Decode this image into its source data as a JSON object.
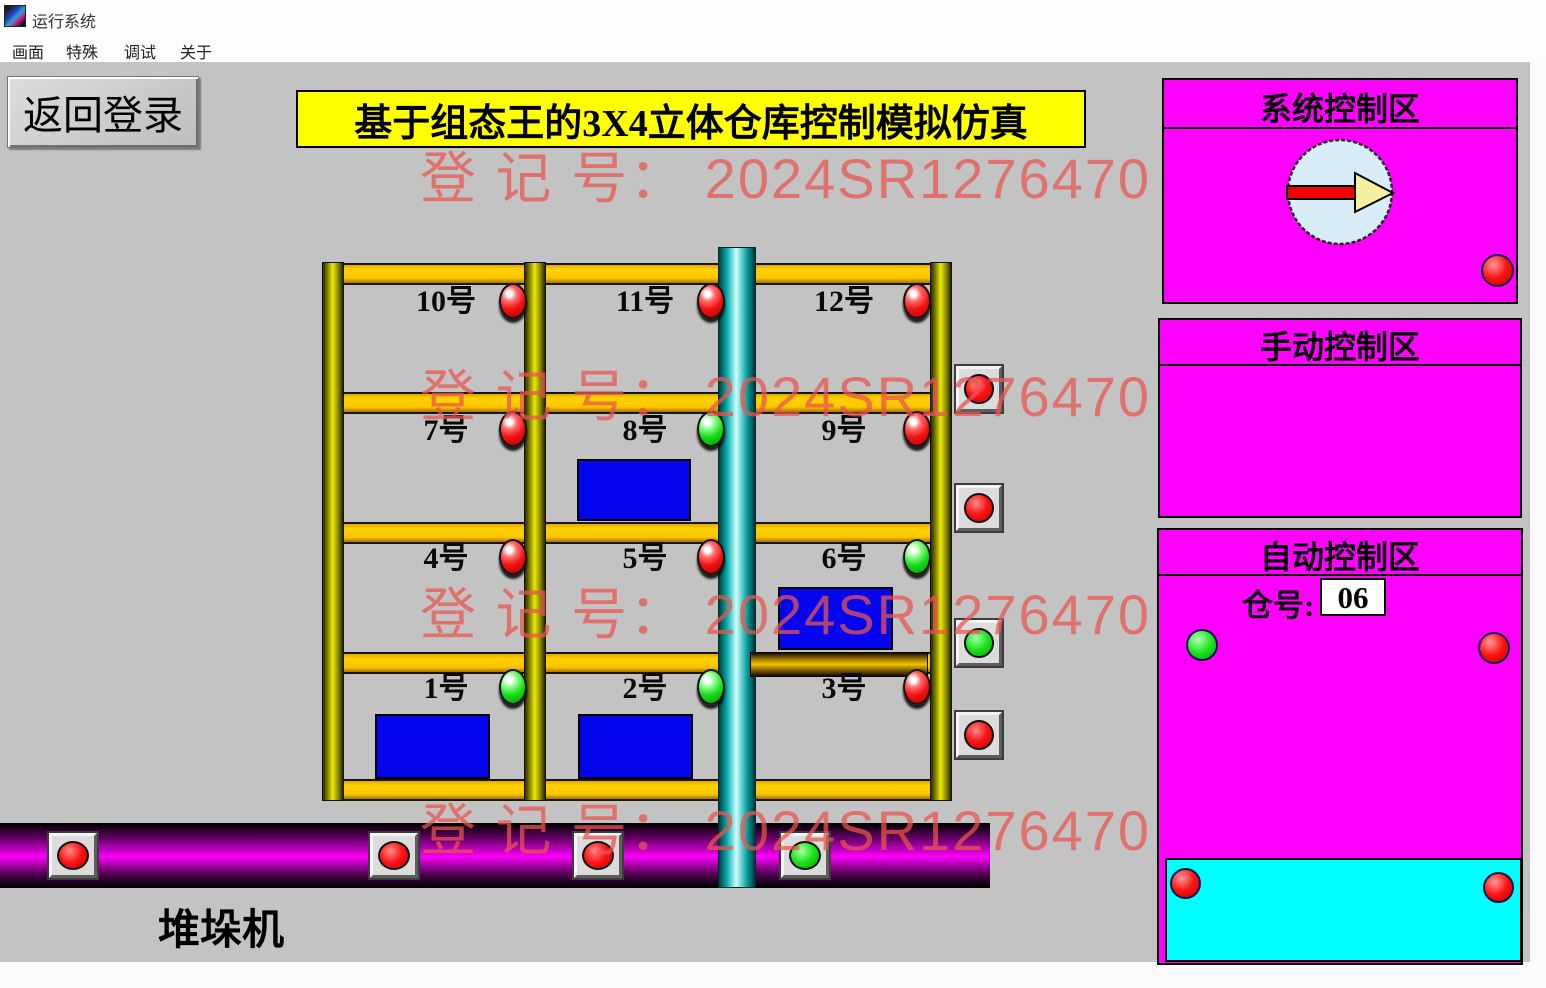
{
  "window": {
    "title": "运行系统",
    "menu": [
      "画面",
      "特殊",
      "调试",
      "关于"
    ]
  },
  "toolbar": {
    "back_button": "返回登录"
  },
  "banner": {
    "text": "基于组态王的3X4立体仓库控制模拟仿真"
  },
  "watermark": {
    "text": "登 记 号：  2024SR1276470",
    "count": 4,
    "color": "#e95650"
  },
  "rack": {
    "stacker_label": "堆垛机",
    "cells": [
      {
        "id": 10,
        "label": "10号",
        "led": "red",
        "has_box": false,
        "row": 0,
        "col": 0
      },
      {
        "id": 11,
        "label": "11号",
        "led": "red",
        "has_box": false,
        "row": 0,
        "col": 1
      },
      {
        "id": 12,
        "label": "12号",
        "led": "red",
        "has_box": false,
        "row": 0,
        "col": 2
      },
      {
        "id": 7,
        "label": "7号",
        "led": "red",
        "has_box": false,
        "row": 1,
        "col": 0
      },
      {
        "id": 8,
        "label": "8号",
        "led": "green",
        "has_box": true,
        "row": 1,
        "col": 1
      },
      {
        "id": 9,
        "label": "9号",
        "led": "red",
        "has_box": false,
        "row": 1,
        "col": 2
      },
      {
        "id": 4,
        "label": "4号",
        "led": "red",
        "has_box": false,
        "row": 2,
        "col": 0
      },
      {
        "id": 5,
        "label": "5号",
        "led": "red",
        "has_box": false,
        "row": 2,
        "col": 1
      },
      {
        "id": 6,
        "label": "6号",
        "led": "green",
        "has_box": true,
        "row": 2,
        "col": 2
      },
      {
        "id": 1,
        "label": "1号",
        "led": "green",
        "has_box": true,
        "row": 3,
        "col": 0
      },
      {
        "id": 2,
        "label": "2号",
        "led": "green",
        "has_box": true,
        "row": 3,
        "col": 1
      },
      {
        "id": 3,
        "label": "3号",
        "led": "red",
        "has_box": false,
        "row": 3,
        "col": 2
      }
    ],
    "side_buttons": [
      "red",
      "red",
      "green",
      "red"
    ],
    "conveyor_buttons": [
      "red",
      "red",
      "red",
      "green"
    ]
  },
  "system_panel": {
    "title": "系统控制区",
    "manual": "手动",
    "auto": "自动",
    "reset": "复位",
    "estop": "急停",
    "estop_lamp": "red",
    "dial_direction": "right"
  },
  "manual_panel": {
    "title": "手动控制区",
    "back": "后退",
    "up": "上升",
    "down": "下降",
    "forward": "前进",
    "retract": "缩回",
    "extend": "伸出"
  },
  "auto_panel": {
    "title": "自动控制区",
    "bin_label": "仓号:",
    "bin_value": "06",
    "store": "存货",
    "store_lamp": "green",
    "fetch": "取货",
    "fetch_lamp": "red",
    "keypad": [
      [
        "10",
        "11",
        "12"
      ],
      [
        "7",
        "8",
        "9"
      ],
      [
        "4",
        "5",
        "6"
      ],
      [
        "1",
        "2",
        "3"
      ]
    ],
    "sim": {
      "full": "满仓模拟",
      "empty": "空仓模拟",
      "cancel": "模拟中断取消",
      "left_lamp": "red",
      "right_lamp": "red"
    }
  },
  "colors": {
    "panel_magenta": "#ff00ff",
    "sim_cyan": "#00ffff",
    "banner_yellow": "#ffff00",
    "beam_gold": "#ffc600",
    "cargo_blue": "#0404ee",
    "client_gray": "#c3c3c3",
    "conveyor_magenta": "#fb00fb"
  }
}
